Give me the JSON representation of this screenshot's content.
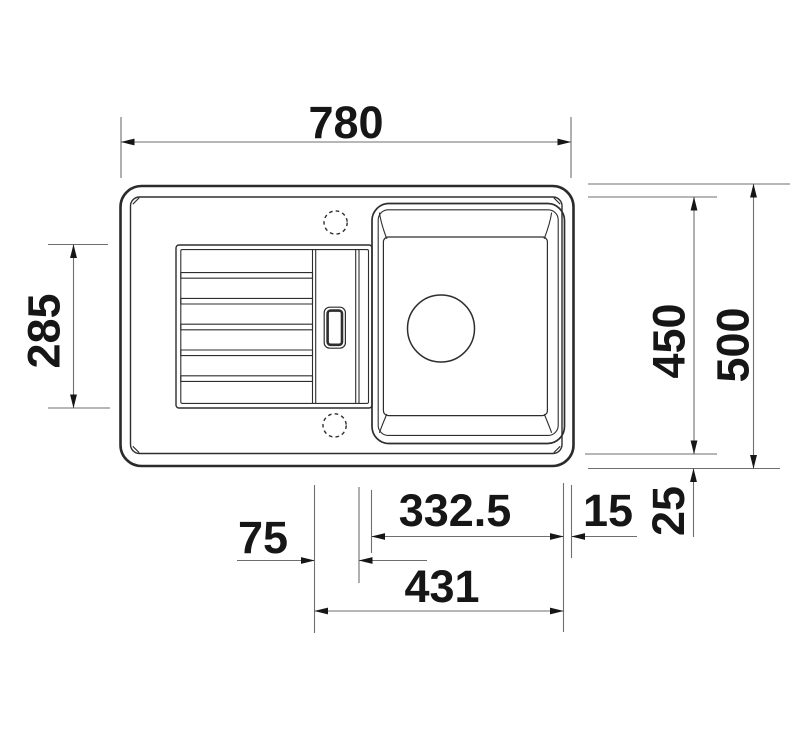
{
  "figure": {
    "type": "technical-drawing",
    "subject": "Kitchen sink with drainer board and bowl - top view dimension drawing",
    "units": "mm",
    "colors": {
      "outline": "#2b2b2b",
      "dimension_line": "#6f6f6f",
      "dimension_text": "#161616",
      "background": "#ffffff"
    },
    "dimensions": {
      "overall_width": "780",
      "drainer_length": "285",
      "inner_depth": "450",
      "overall_depth": "500",
      "tap_hole_offset": "75",
      "bowl_width": "332.5",
      "bowl_edge_gap": "15",
      "rim_gap": "25",
      "bowl_span": "431"
    }
  }
}
